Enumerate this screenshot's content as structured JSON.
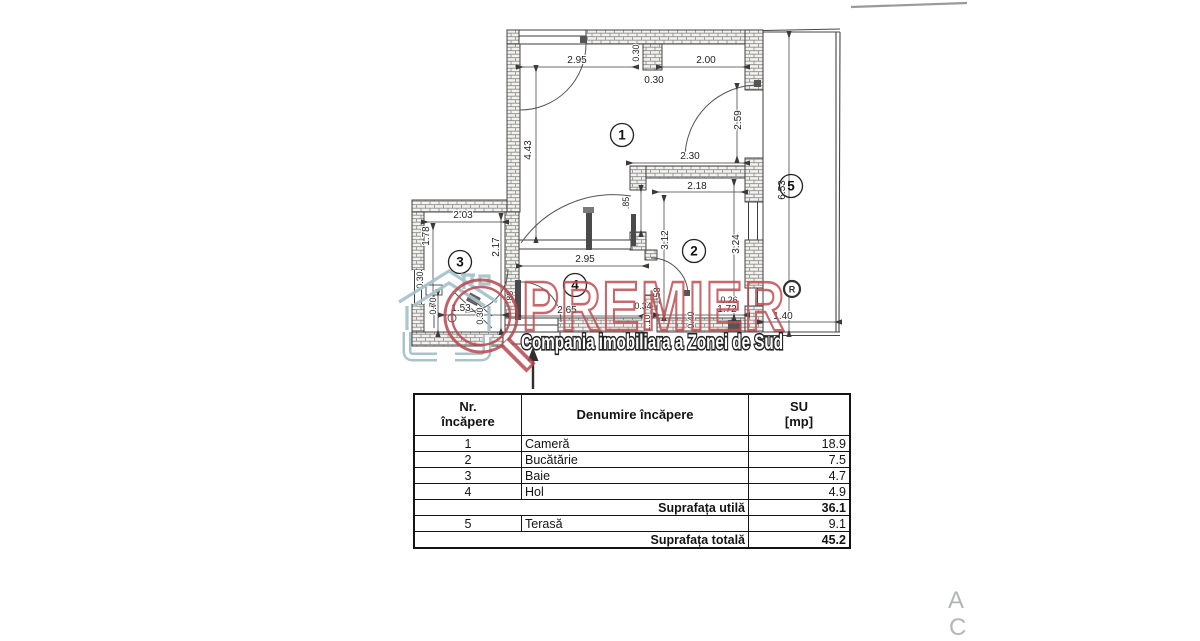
{
  "plan": {
    "rooms": {
      "r1": "1",
      "r2": "2",
      "r3": "3",
      "r4": "4",
      "r5": "5"
    },
    "dims": {
      "w295_top": "2.95",
      "h030_v": "0.30",
      "w030_h": "0.30",
      "w200_top": "2.00",
      "h259": "2.59",
      "h443": "4.43",
      "h653": "6.53",
      "w230": "2.30",
      "w218": "2.18",
      "h085": ".85",
      "h312": "3.12",
      "h324": "3.24",
      "w203": "2.03",
      "h178": "1.78",
      "h217": "2.17",
      "w295_hall": "2.95",
      "h030_left": "0.30",
      "h070": "0.70",
      "w153": "1.53",
      "h030_bath": "0.30",
      "w265": "2.65",
      "h088": ".88",
      "w034": "0.34",
      "h110": "1.10",
      "h158": "1.58",
      "h040": "0.40",
      "w172": "1.72",
      "w026": "0.26",
      "w140": "1.40"
    }
  },
  "watermark": {
    "brand": "PREMIER",
    "tagline": "Compania imobiliara a Zonei de Sud",
    "registered": "R"
  },
  "table": {
    "header": {
      "nr_line1": "Nr.",
      "nr_line2": "încăpere",
      "name": "Denumire încăpere",
      "su_line1": "SU",
      "su_line2": "[mp]"
    },
    "rows": [
      {
        "nr": "1",
        "name": "Cameră",
        "su": "18.9"
      },
      {
        "nr": "2",
        "name": "Bucătărie",
        "su": "7.5"
      },
      {
        "nr": "3",
        "name": "Baie",
        "su": "4.7"
      },
      {
        "nr": "4",
        "name": "Hol",
        "su": "4.9"
      }
    ],
    "util_label": "Suprafața utilă",
    "util_value": "36.1",
    "terasa_row": {
      "nr": "5",
      "name": "Terasă",
      "su": "9.1"
    },
    "total_label": "Suprafața totală",
    "total_value": "45.2"
  },
  "misc": {
    "corner_letter_a": "A",
    "corner_letter_c": "C"
  }
}
